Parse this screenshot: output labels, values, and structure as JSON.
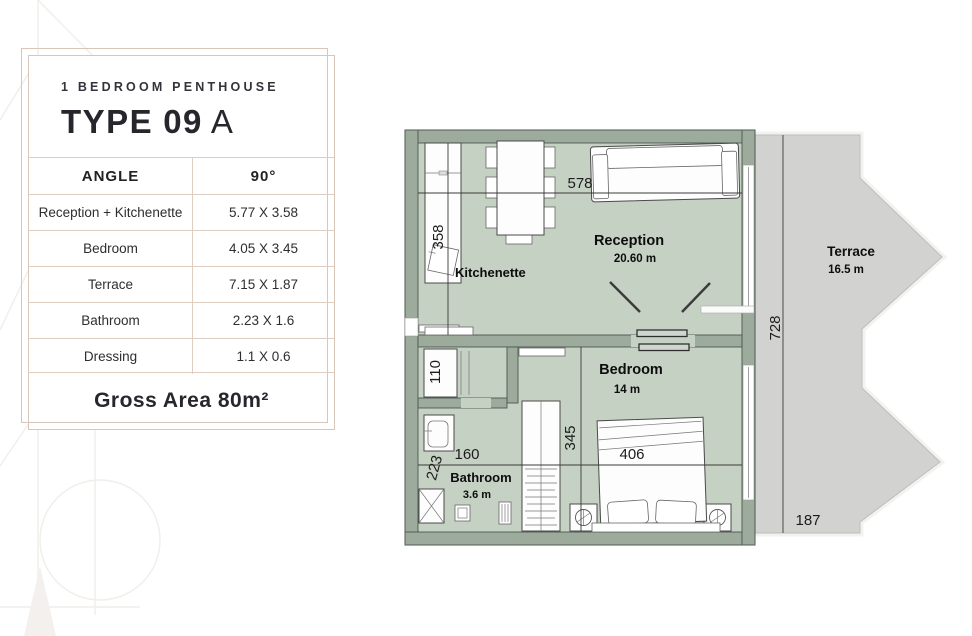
{
  "colors": {
    "wall": "#9cab9c",
    "floor": "#c5d1c3",
    "terrace": "#d2d3d0",
    "frame": "#d9c6ba",
    "ink": "#26262c"
  },
  "card": {
    "category": "1 BEDROOM PENTHOUSE",
    "type_label": "TYPE",
    "type_number": "09",
    "type_variant": "A",
    "spec_header": {
      "label": "ANGLE",
      "value": "90°"
    },
    "spec_rows": [
      {
        "label": "Reception + Kitchenette",
        "value": "5.77 X 3.58"
      },
      {
        "label": "Bedroom",
        "value": "4.05 X 3.45"
      },
      {
        "label": "Terrace",
        "value": "7.15 X 1.87"
      },
      {
        "label": "Bathroom",
        "value": "2.23 X 1.6"
      },
      {
        "label": "Dressing",
        "value": "1.1 X 0.6"
      }
    ],
    "gross_area": "Gross Area 80m²"
  },
  "plan": {
    "labels": {
      "kitchenette": "Kitchenette",
      "reception": "Reception",
      "reception_area": "20.60 m",
      "terrace": "Terrace",
      "terrace_area": "16.5 m",
      "bedroom": "Bedroom",
      "bedroom_area": "14 m",
      "bathroom": "Bathroom",
      "bathroom_area": "3.6 m"
    },
    "dims": {
      "reception_width": "578",
      "kitchen_depth": "358",
      "terrace_height": "728",
      "hall_width": "110",
      "bedroom_depth": "345",
      "bedroom_width": "406",
      "bathroom_width": "160",
      "bathroom_depth": "223",
      "terrace_bottom": "187"
    }
  }
}
